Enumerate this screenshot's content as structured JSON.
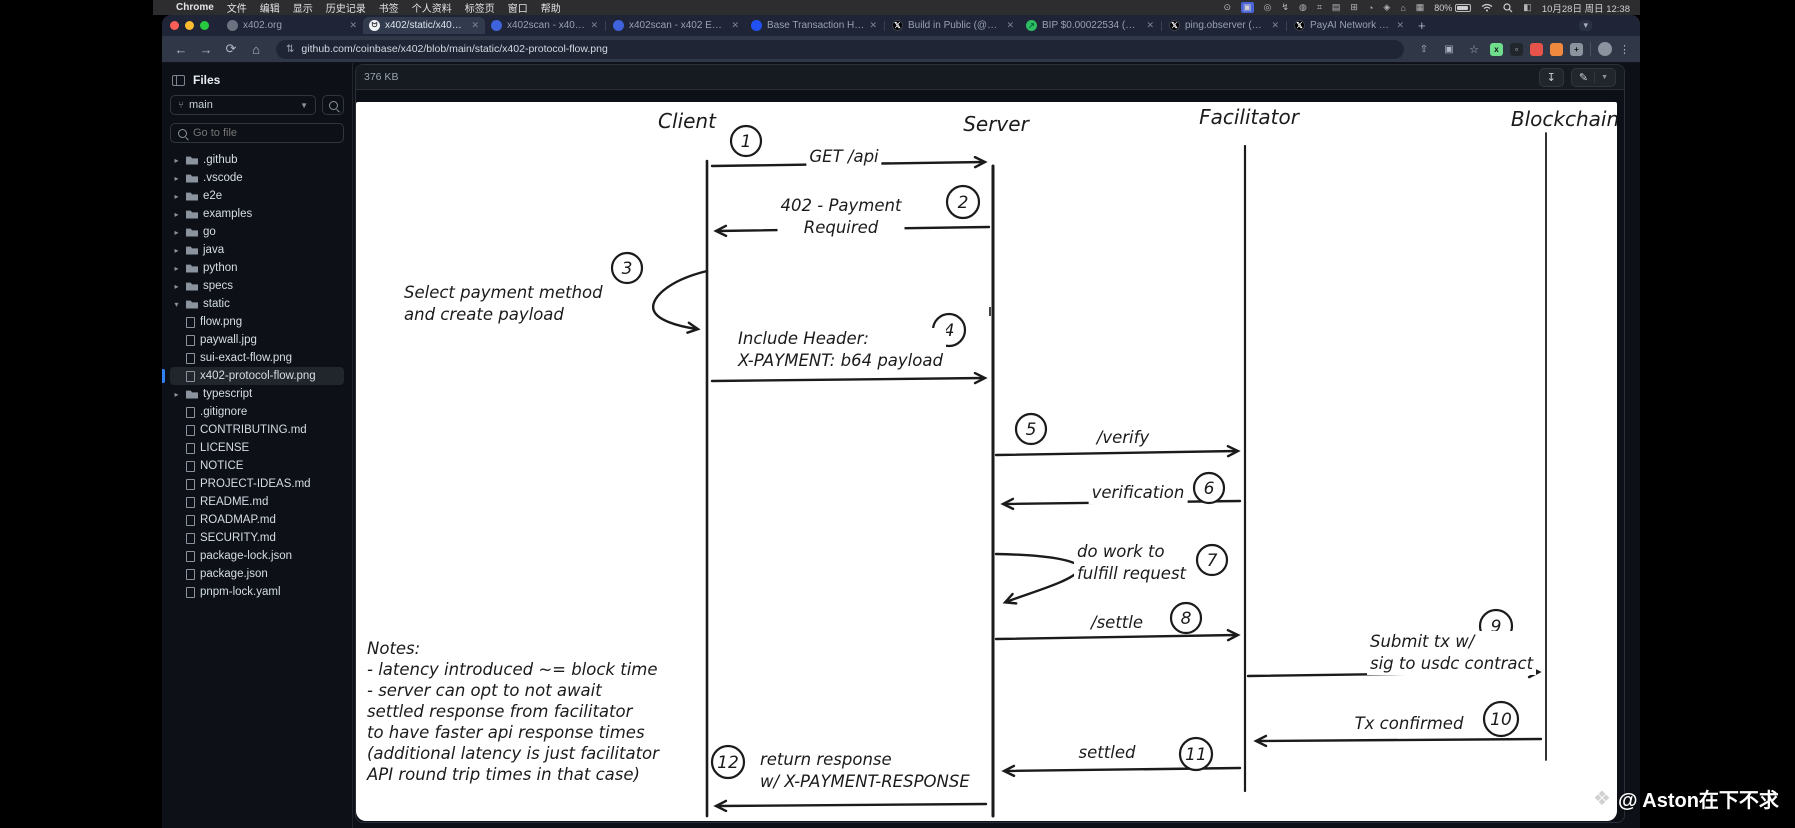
{
  "menubar": {
    "apple": "",
    "items": [
      "Chrome",
      "文件",
      "编辑",
      "显示",
      "历史记录",
      "书签",
      "个人资料",
      "标签页",
      "窗口",
      "帮助"
    ],
    "status": {
      "battery_pct": "80%",
      "datetime": "10月28日 周日 12:38"
    }
  },
  "tabs": [
    {
      "title": "x402.org"
    },
    {
      "title": "x402/static/x402-protocol-fl"
    },
    {
      "title": "x402scan - x402 Ecosystem"
    },
    {
      "title": "x402scan - x402 Ecosystem"
    },
    {
      "title": "Base Transaction Hash: 0x3"
    },
    {
      "title": "Build in Public (@bipx402) / X"
    },
    {
      "title": "BIP $0.00022534 (BuildInP"
    },
    {
      "title": "ping.observer (@pingobser"
    },
    {
      "title": "PayAI Network | x402 Facilit"
    }
  ],
  "toolbar": {
    "url": "github.com/coinbase/x402/blob/main/static/x402-protocol-flow.png"
  },
  "sidebar": {
    "title": "Files",
    "branch": "main",
    "goto_placeholder": "Go to file",
    "tree": [
      {
        "label": ".github",
        "kind": "folder"
      },
      {
        "label": ".vscode",
        "kind": "folder"
      },
      {
        "label": "e2e",
        "kind": "folder"
      },
      {
        "label": "examples",
        "kind": "folder"
      },
      {
        "label": "go",
        "kind": "folder"
      },
      {
        "label": "java",
        "kind": "folder"
      },
      {
        "label": "python",
        "kind": "folder"
      },
      {
        "label": "specs",
        "kind": "folder"
      },
      {
        "label": "static",
        "kind": "folder",
        "expanded": true
      },
      {
        "label": "flow.png",
        "kind": "file",
        "depth": 1
      },
      {
        "label": "paywall.jpg",
        "kind": "file",
        "depth": 1
      },
      {
        "label": "sui-exact-flow.png",
        "kind": "file",
        "depth": 1
      },
      {
        "label": "x402-protocol-flow.png",
        "kind": "file",
        "depth": 1,
        "selected": true
      },
      {
        "label": "typescript",
        "kind": "folder"
      },
      {
        "label": ".gitignore",
        "kind": "file"
      },
      {
        "label": "CONTRIBUTING.md",
        "kind": "file"
      },
      {
        "label": "LICENSE",
        "kind": "file"
      },
      {
        "label": "NOTICE",
        "kind": "file"
      },
      {
        "label": "PROJECT-IDEAS.md",
        "kind": "file"
      },
      {
        "label": "README.md",
        "kind": "file"
      },
      {
        "label": "ROADMAP.md",
        "kind": "file"
      },
      {
        "label": "SECURITY.md",
        "kind": "file"
      },
      {
        "label": "package-lock.json",
        "kind": "file"
      },
      {
        "label": "package.json",
        "kind": "file"
      },
      {
        "label": "pnpm-lock.yaml",
        "kind": "file"
      }
    ]
  },
  "viewer": {
    "file_size": "376 KB"
  },
  "diagram": {
    "actors": [
      "Client",
      "Server",
      "Facilitator",
      "Blockchain"
    ],
    "messages": [
      {
        "num": "1",
        "lines": [
          "GET /api"
        ]
      },
      {
        "num": "2",
        "lines": [
          "402 - Payment",
          "Required"
        ]
      },
      {
        "num": "3",
        "lines": [
          "Select payment method",
          "and create payload"
        ]
      },
      {
        "num": "4",
        "lines": [
          "Include Header:",
          "X-PAYMENT: b64 payload"
        ]
      },
      {
        "num": "5",
        "lines": [
          "/verify"
        ]
      },
      {
        "num": "6",
        "lines": [
          "verification"
        ]
      },
      {
        "num": "7",
        "lines": [
          "do work to",
          "fulfill request"
        ]
      },
      {
        "num": "8",
        "lines": [
          "/settle"
        ]
      },
      {
        "num": "9",
        "lines": [
          "Submit tx w/",
          "sig to usdc contract"
        ]
      },
      {
        "num": "10",
        "lines": [
          "Tx confirmed"
        ]
      },
      {
        "num": "11",
        "lines": [
          "settled"
        ]
      },
      {
        "num": "12",
        "lines": [
          "return response",
          "w/ X-PAYMENT-RESPONSE"
        ]
      }
    ],
    "notes": {
      "lines": [
        "Notes:",
        "- latency introduced ~= block time",
        "- server can opt to not await",
        "settled response from facilitator",
        "to have faster api response times",
        "(additional latency is just facilitator",
        "API round trip times in that case)"
      ]
    }
  },
  "watermark": "@ Aston在下不求"
}
